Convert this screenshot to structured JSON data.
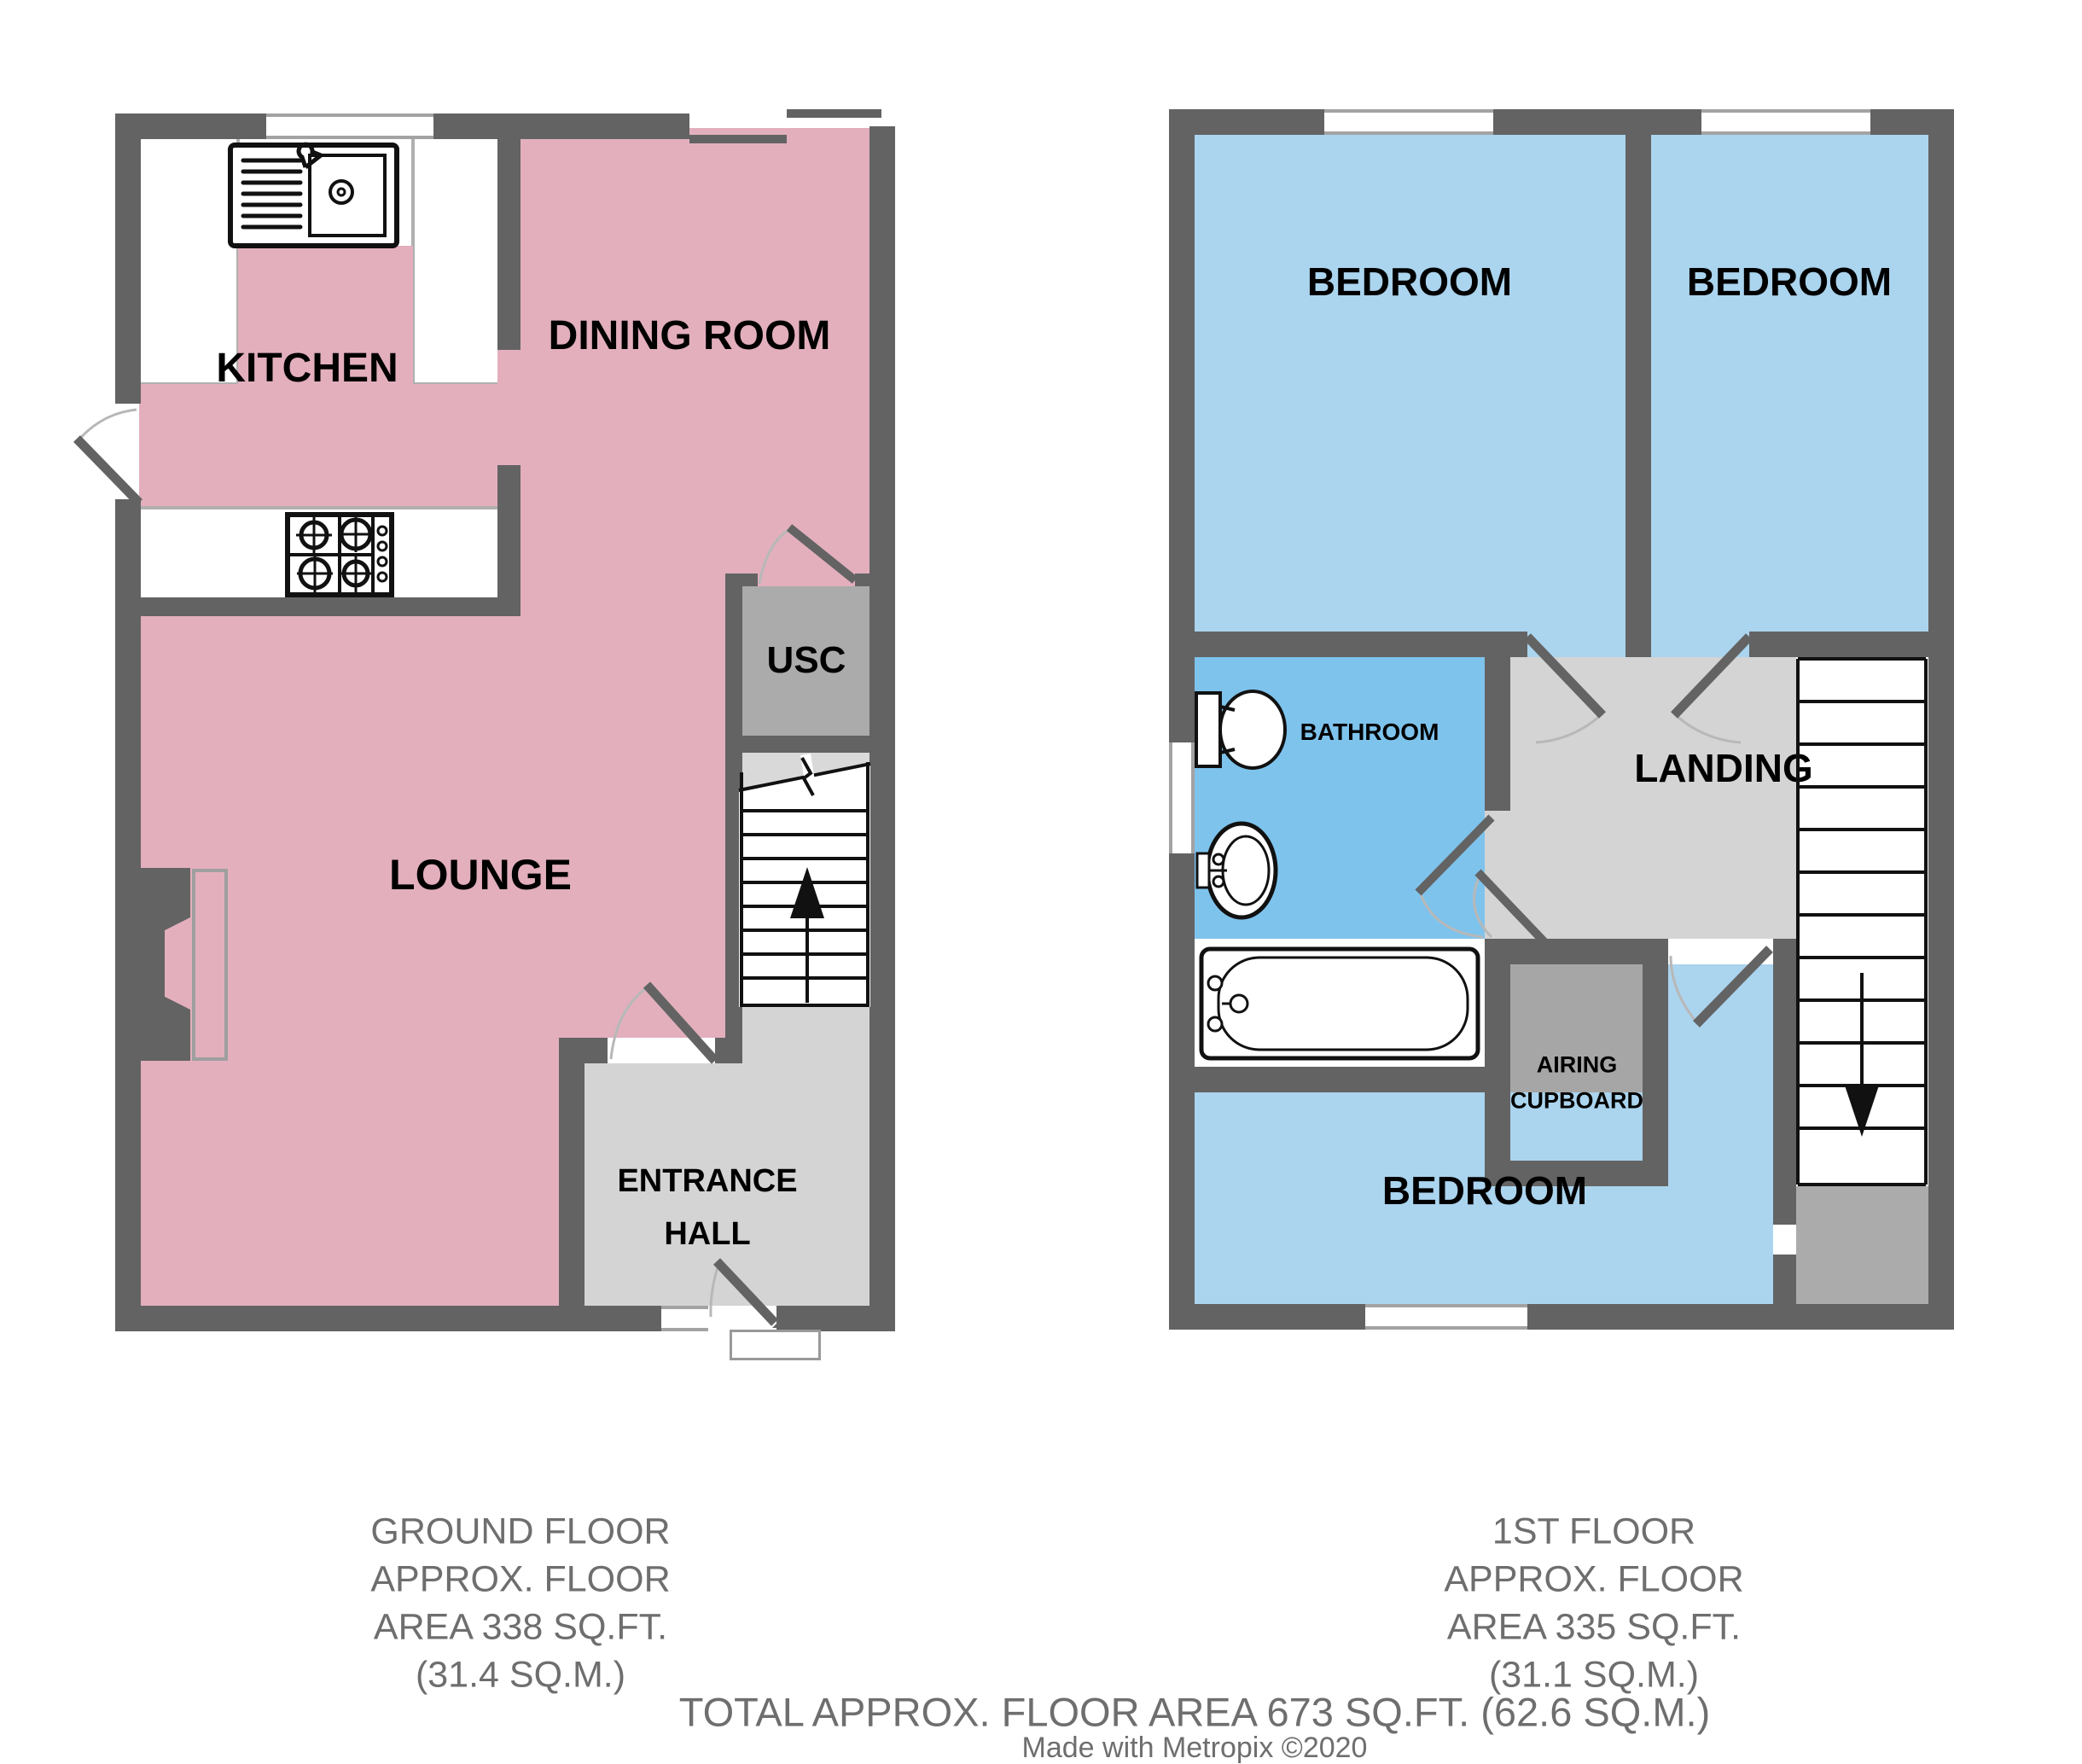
{
  "colors": {
    "wall": "#636363",
    "pink": "#e3afbd",
    "bedroom": "#abd4ee",
    "bathroom": "#7ec3ec",
    "hall": "#d4d4d4",
    "cupboard": "#ababab",
    "airing": "#a6a6a6",
    "winline": "#a3a3a3",
    "counterline": "#b0b0b0",
    "caption": "#6e6e6e",
    "arc": "#b8b8b8",
    "ink": "#111111"
  },
  "ground_floor": {
    "rooms": {
      "kitchen": "KITCHEN",
      "dining": "DINING ROOM",
      "lounge": "LOUNGE",
      "usc": "USC",
      "entrance_line1": "ENTRANCE",
      "entrance_line2": "HALL"
    },
    "caption": {
      "line1": "GROUND FLOOR",
      "line2": "APPROX. FLOOR",
      "line3": "AREA 338 SQ.FT.",
      "line4": "(31.4 SQ.M.)"
    }
  },
  "first_floor": {
    "rooms": {
      "bedroom_left": "BEDROOM",
      "bedroom_right": "BEDROOM",
      "bedroom_main": "BEDROOM",
      "bathroom": "BATHROOM",
      "landing": "LANDING",
      "airing_line1": "AIRING",
      "airing_line2": "CUPBOARD"
    },
    "caption": {
      "line1": "1ST FLOOR",
      "line2": "APPROX. FLOOR",
      "line3": "AREA 335 SQ.FT.",
      "line4": "(31.1 SQ.M.)"
    }
  },
  "footer": {
    "total": "TOTAL APPROX. FLOOR AREA 673 SQ.FT. (62.6 SQ.M.)",
    "credit": "Made with Metropix ©2020"
  }
}
